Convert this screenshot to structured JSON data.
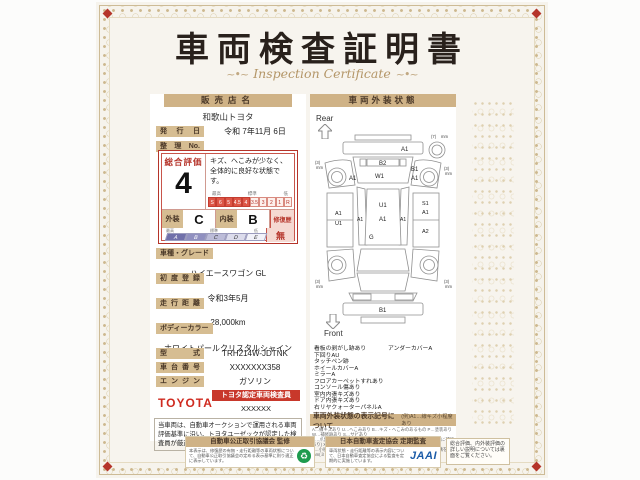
{
  "title": {
    "main": "車両検査証明書",
    "sub": "Inspection Certificate",
    "flourish": "~"
  },
  "left": {
    "dealer_header": "販売店名",
    "dealer_name": "和歌山トヨタ",
    "issue_label": "発行日",
    "issue_value": "令和 7年11月 6日",
    "ref_label": "整理No.",
    "ref_value": "",
    "rating": {
      "header": "総合評価",
      "score": "4",
      "comment": "キズ、へこみが少なく、全体的に良好な状態です。",
      "scale_max": "最高",
      "scale_mid": "標準",
      "scale_min": "低",
      "scale_cells": [
        "S",
        "6",
        "5",
        "4.5",
        "4",
        "3.5",
        "3",
        "2",
        "1",
        "R"
      ],
      "exterior_label": "外装",
      "exterior_value": "C",
      "interior_label": "内装",
      "interior_value": "B",
      "repair_label": "修復歴",
      "repair_value": "無",
      "grade_cells": [
        "A",
        "B",
        "C",
        "D",
        "E"
      ],
      "grade_max": "最高",
      "grade_mid": "標準",
      "grade_min": "低"
    },
    "rows": [
      {
        "label": "車種・グレード",
        "value": "ハイエースワゴン GL"
      },
      {
        "label": "初度登録",
        "value": "令和3年5月"
      },
      {
        "label": "走行距離",
        "value": "28,000km"
      },
      {
        "label": "ボディーカラー",
        "value": "ホワイトパールクリスタルシャイン"
      },
      {
        "label": "型式",
        "value": "TRH214W-JDTNK"
      },
      {
        "label": "車台番号",
        "value": "XXXXXXX358"
      },
      {
        "label": "エンジン",
        "value": "ガソリン"
      }
    ],
    "toyota_logo": "TOYOTA",
    "certified_badge": "トヨタ認定車両検査員",
    "inspector_id": "XXXXXX",
    "disclaimer": "当車両は、自動車オークションで運用される車両評価基準に沿い、トヨタユーゼックが認定した検査員が厳正に検査・評価いたしました。"
  },
  "right": {
    "header": "車両外装状態",
    "rear_label": "Rear",
    "front_label": "Front",
    "remarks_left": [
      "看板の剥がし跡あり",
      "下回りAU",
      "タッチペン跡",
      "ホイールカバーA",
      "ミラーA",
      "フロアカーペットすれあり",
      "コンソール傷あり",
      "室内内張キズあり",
      "ドア内張キズあり",
      "右リヤクォーターパネルA"
    ],
    "remarks_right": [
      "アンダーカバーA"
    ],
    "symbol_title": "車両外装状態の表示記号について",
    "symbol_example": "(例)A1…線キズ小程度あり",
    "legend_lines": [
      "A…線キズあり U…へこみあり B…キズ・へこみのあるもの P…塗装あり W…補修跡あり S…サビあり",
      "C…爪割れあり G…フロントガラスキズあり Y…裂けあり(穴・亀裂に補修あり) XX…交換歴あり",
      "1…小程度 2…中程度 3…中程度以上 ・タイヤ残り溝表示は、残り溝をmm(ミリ)で表しています。"
    ]
  },
  "diagram": {
    "rear_bumper": "A1",
    "rear_window": "B2",
    "tailgate": "W1",
    "right_rear_1": "B1",
    "right_rear_2": "A1",
    "left_rear": "A1",
    "roof_1": "U1",
    "roof_2": "A1",
    "roof_g": "G",
    "left_rail": "A1",
    "right_rail": "A1",
    "left_body_1": "A1",
    "left_body_2": "U1",
    "right_body_1": "S1",
    "right_body_2": "A1",
    "right_body_3": "A2",
    "front_bumper": "B1",
    "wheel_rl": "(3)",
    "wheel_rr": "(3)",
    "wheel_fl": "(3)",
    "wheel_fr": "(3)",
    "spare": "(7)",
    "mm_unit": "mm"
  },
  "footer": {
    "left_header": "自動車公正取引協議会 監修",
    "left_text": "本表示は、修復歴の有無・走行距離等の車両状態について、自動車公正取引協議会の定める表示基準に則り適正に表示しています。",
    "middle_header": "日本自動車査定協会 定期監査",
    "middle_text": "車両状態・走行距離等の表示内容について、日本自動車査定協会による監査を定期的に実施しています。",
    "jaai_logo": "JAAI",
    "right_text": "総合評価、内外装評価の詳しい説明については裏面をご覧ください。"
  }
}
